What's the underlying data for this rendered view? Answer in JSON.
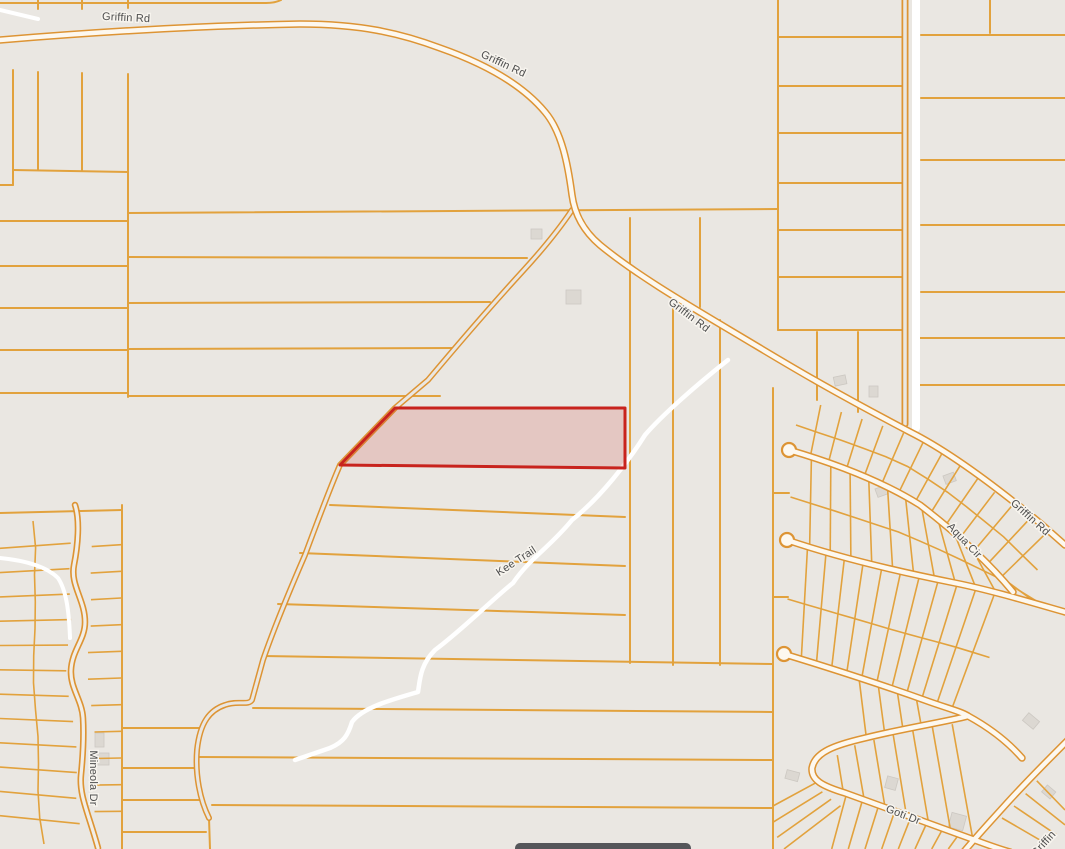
{
  "map": {
    "colors": {
      "background": "#eae7e2",
      "parcel_line": "#e2a23d",
      "road_casing": "#dd9434",
      "road_fill": "#fdf8ef",
      "trail": "#ffffff",
      "selected_parcel_stroke": "#c8231d",
      "selected_parcel_fill": "rgba(203,57,50,0.18)",
      "building": "#dcd8d2",
      "label_text": "#4e4e4e",
      "bottom_toolbar": "#55565a"
    },
    "road_labels": {
      "griffin_rd_top": "Griffin Rd",
      "griffin_rd_curve": "Griffin Rd",
      "griffin_rd_mid": "Griffin Rd",
      "griffin_rd_right": "Griffin Rd",
      "griffin_rd_corner": "Griffin",
      "aqua_cir": "Aqua Cir",
      "kee_trail": "Kee Trail",
      "mineola_dr": "Mineola Dr",
      "goti_dr": "Goti Dr"
    },
    "selected_parcel": {
      "highlighted": "true"
    }
  }
}
